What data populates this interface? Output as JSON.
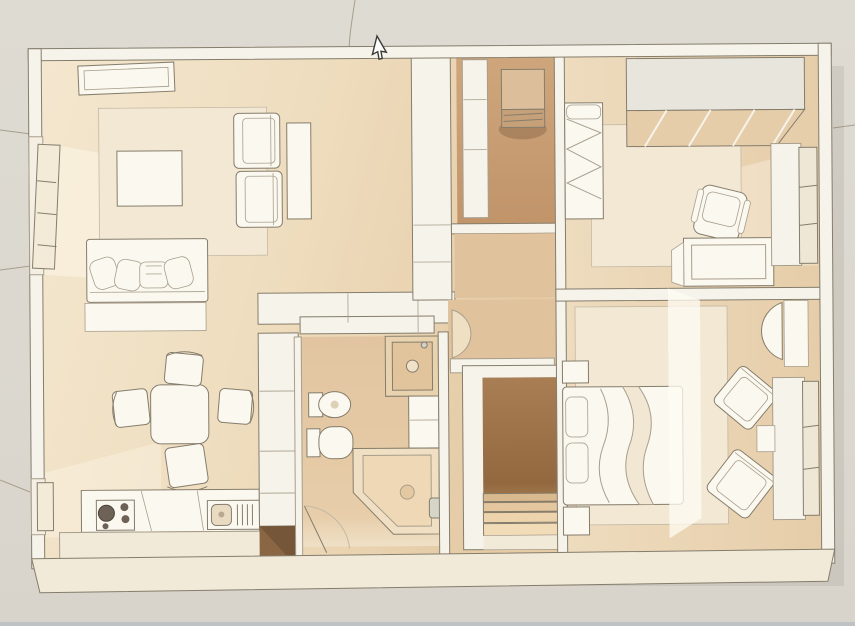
{
  "image": {
    "description": "Top-down 3D rendered floor plan of an apartment shown in a viewer; a mouse arrow cursor hovers near the top wall",
    "style": "sketchy architectural render, warm beige/cream palette, no text labels"
  },
  "colors": {
    "bg_top": "#dedbd3",
    "bg_mid": "#dbd7cf",
    "bg_bottom": "#d8d4cc",
    "bottom_edge_line": "#bfc2c5",
    "wall_white": "#f6f3ea",
    "furn_white": "#fbf8f0",
    "rug_cream": "#f3e8d3",
    "floor_light": "#f2e3c9",
    "floor_warm": "#ead5b4",
    "floor_tan": "#e0c29c",
    "floor_dark": "#c69c72",
    "stair_dark": "#9c7049",
    "door_dark": "#8a6644",
    "wardrobe_gray": "#e8e5dc",
    "cream_band": "#f2ead8",
    "line_dark": "#857d6c",
    "line_soft": "#a89e8c",
    "line_faint": "#c4b9a4",
    "burner_dark": "#6e6257",
    "shadow": "rgba(140,110,75,0.22)"
  },
  "cursor": {
    "icon": "arrow-cursor",
    "x": 377,
    "y": 36
  },
  "rooms": [
    {
      "id": "living-room",
      "evidence": "sofa, coffee table, two armchairs, ceiling light panel"
    },
    {
      "id": "dining-kitchen",
      "evidence": "square table with four chairs, counter with cooktop and sink"
    },
    {
      "id": "storage-room",
      "evidence": "small room with water heater box and shelf"
    },
    {
      "id": "bedroom-top-right",
      "evidence": "single bed, wardrobe, desk with office chair"
    },
    {
      "id": "bathroom",
      "evidence": "corner bathtub, toilet, bidet, vanity"
    },
    {
      "id": "stairwell",
      "evidence": "dark well with treads"
    },
    {
      "id": "bedroom-bottom-right",
      "evidence": "double bed, two rotated armchairs, dressing table"
    }
  ]
}
